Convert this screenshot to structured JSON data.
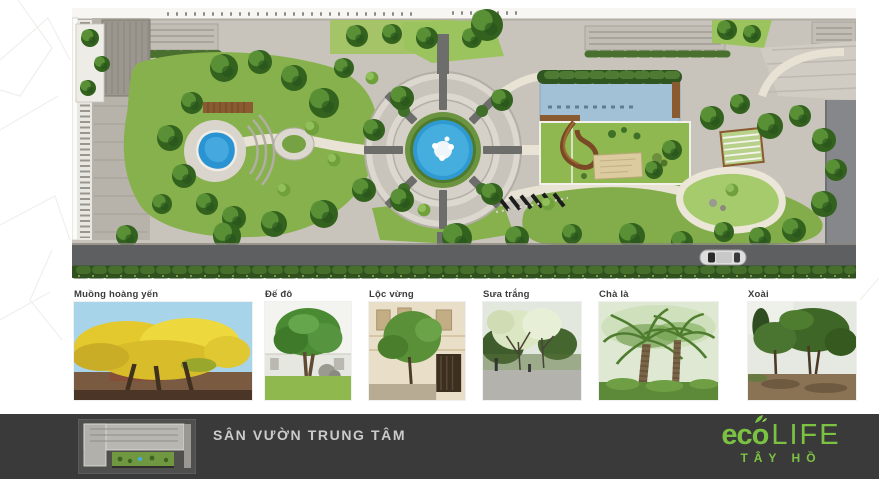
{
  "tree_photos": [
    {
      "label": "Muồng hoàng yến"
    },
    {
      "label": "Đế đô"
    },
    {
      "label": "Lộc vừng"
    },
    {
      "label": "Sưa trắng"
    },
    {
      "label": "Chà là"
    },
    {
      "label": "Xoài"
    }
  ],
  "footer": {
    "title": "SÂN VƯỜN TRUNG TÂM",
    "logo": {
      "eco": "ec",
      "o": "o",
      "life": "LIFE",
      "subtitle": "TÂY HỒ"
    },
    "colors": {
      "bar": "#3A3A3A",
      "logo_green": "#7CC242",
      "title_text": "#CBCBCB"
    }
  }
}
